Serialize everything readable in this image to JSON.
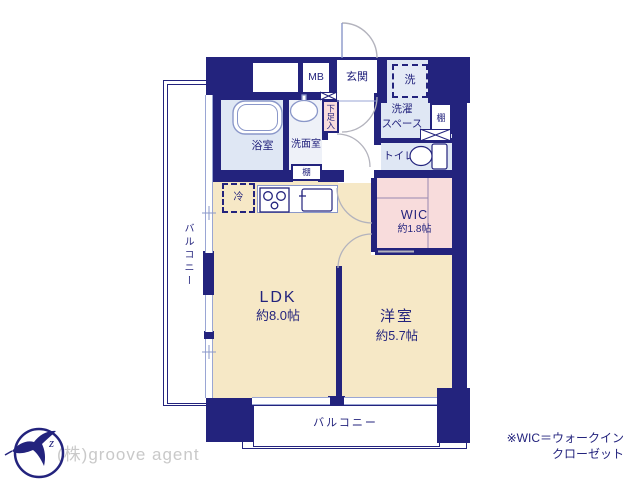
{
  "colors": {
    "navy": "#23237d",
    "cream": "#f6e8c6",
    "pink": "#f8dcdc",
    "wet_blue": "#dfe7f4",
    "washroom_blue": "#eef1f8",
    "fixture_stroke": "#8a97c9",
    "window_line": "#9aa6d4",
    "door_arc_gray": "#b3b3bd",
    "company_text_gray": "#c9c9c9"
  },
  "floor_plan": {
    "rooms": {
      "ldk": {
        "name": "LDK",
        "size": "約8.0帖"
      },
      "western_room": {
        "name": "洋室",
        "size": "約5.7帖"
      },
      "wic": {
        "name": "WIC",
        "size": "約1.8帖"
      },
      "bathroom": {
        "name": "浴室"
      },
      "washroom": {
        "name": "洗面室"
      },
      "toilet": {
        "name": "トイレ"
      },
      "entrance": {
        "name": "玄関"
      },
      "laundry_space": {
        "line1": "洗濯",
        "line2": "スペース",
        "washer": "洗"
      },
      "balcony_left": {
        "name": "バルコニー"
      },
      "balcony_bottom": {
        "name": "バルコニー"
      }
    },
    "fixtures": {
      "meter_box": "MB",
      "refrigerator": "冷",
      "shoe_cabinet": "下足入",
      "shelf_laundry": "棚",
      "shelf_washroom": "棚"
    }
  },
  "footer": {
    "company": "(株)groove agent",
    "note_line1": "※WIC＝ウォークイン",
    "note_line2": "クローゼット"
  }
}
